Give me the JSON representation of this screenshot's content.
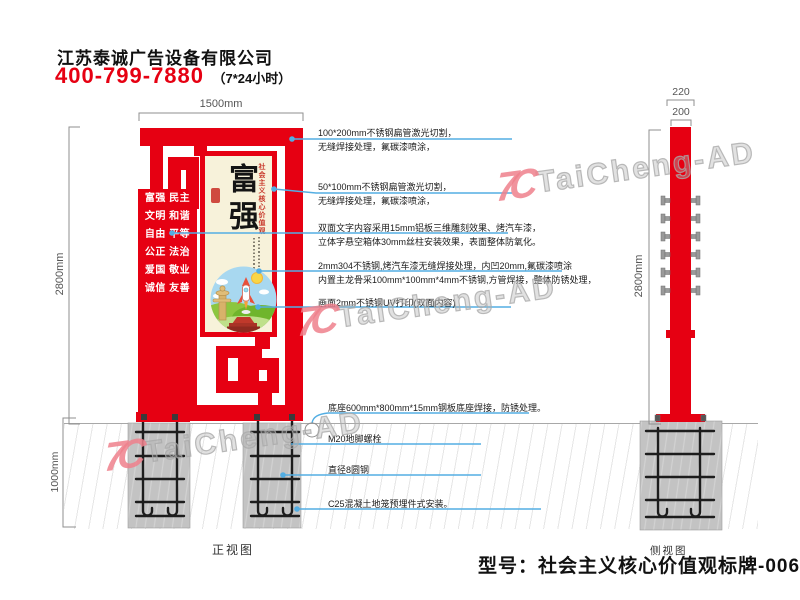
{
  "header": {
    "company": "江苏泰诚广告设备有限公司",
    "phone": "400-799-7880",
    "hours": "（7*24小时）"
  },
  "front_view": {
    "label": "正视图",
    "dim_width": "1500mm",
    "dim_height": "2800mm",
    "dim_foundation": "1000mm",
    "values_rows": [
      "富强 民主",
      "文明 和谐",
      "自由 平等",
      "公正 法治",
      "爱国 敬业",
      "诚信 友善"
    ],
    "poster_title": "富强",
    "poster_side_title": "社会主义核心价值观"
  },
  "side_view": {
    "label": "侧视图",
    "dim_outer": "220",
    "dim_inner": "200",
    "dim_height": "2800mm"
  },
  "annotations": [
    {
      "lines": [
        "100*200mm不锈钢扁管激光切割，",
        "无缝焊接处理，氟碳漆喷涂，"
      ]
    },
    {
      "lines": [
        "50*100mm不锈钢扁管激光切割，",
        "无缝焊接处理，氟碳漆喷涂，"
      ]
    },
    {
      "lines": [
        "双面文字内容采用15mm铝板三维雕刻效果、烤汽车漆，",
        "立体字悬空箱体30mm丝柱安装效果，表面整体防氧化。"
      ]
    },
    {
      "lines": [
        "2mm304不锈钢,烤汽车漆无缝焊接处理，内凹20mm,氟碳漆喷涂",
        "内置主龙骨采100mm*100mm*4mm不锈钢,方管焊接，整体防锈处理，"
      ]
    },
    {
      "lines": [
        "画面2mm不锈钢UV打印(双面内容)"
      ]
    },
    {
      "lines": [
        "底座600mm*800mm*15mm钢板底座焊接，防锈处理。"
      ]
    },
    {
      "lines": [
        "M20地脚螺栓"
      ]
    },
    {
      "lines": [
        "直径8圆钢"
      ]
    },
    {
      "lines": [
        "C25混凝土地笼预埋件式安装。"
      ]
    }
  ],
  "model_label": "型号：社会主义核心价值观标牌-0062",
  "watermark": {
    "logo": "7C",
    "text": "TaiCheng-AD"
  },
  "colors": {
    "brand_red": "#e60012",
    "leader_blue": "#53aee3",
    "poster_cream": "#f7f2da",
    "concrete_gray": "#c3c3c3"
  }
}
